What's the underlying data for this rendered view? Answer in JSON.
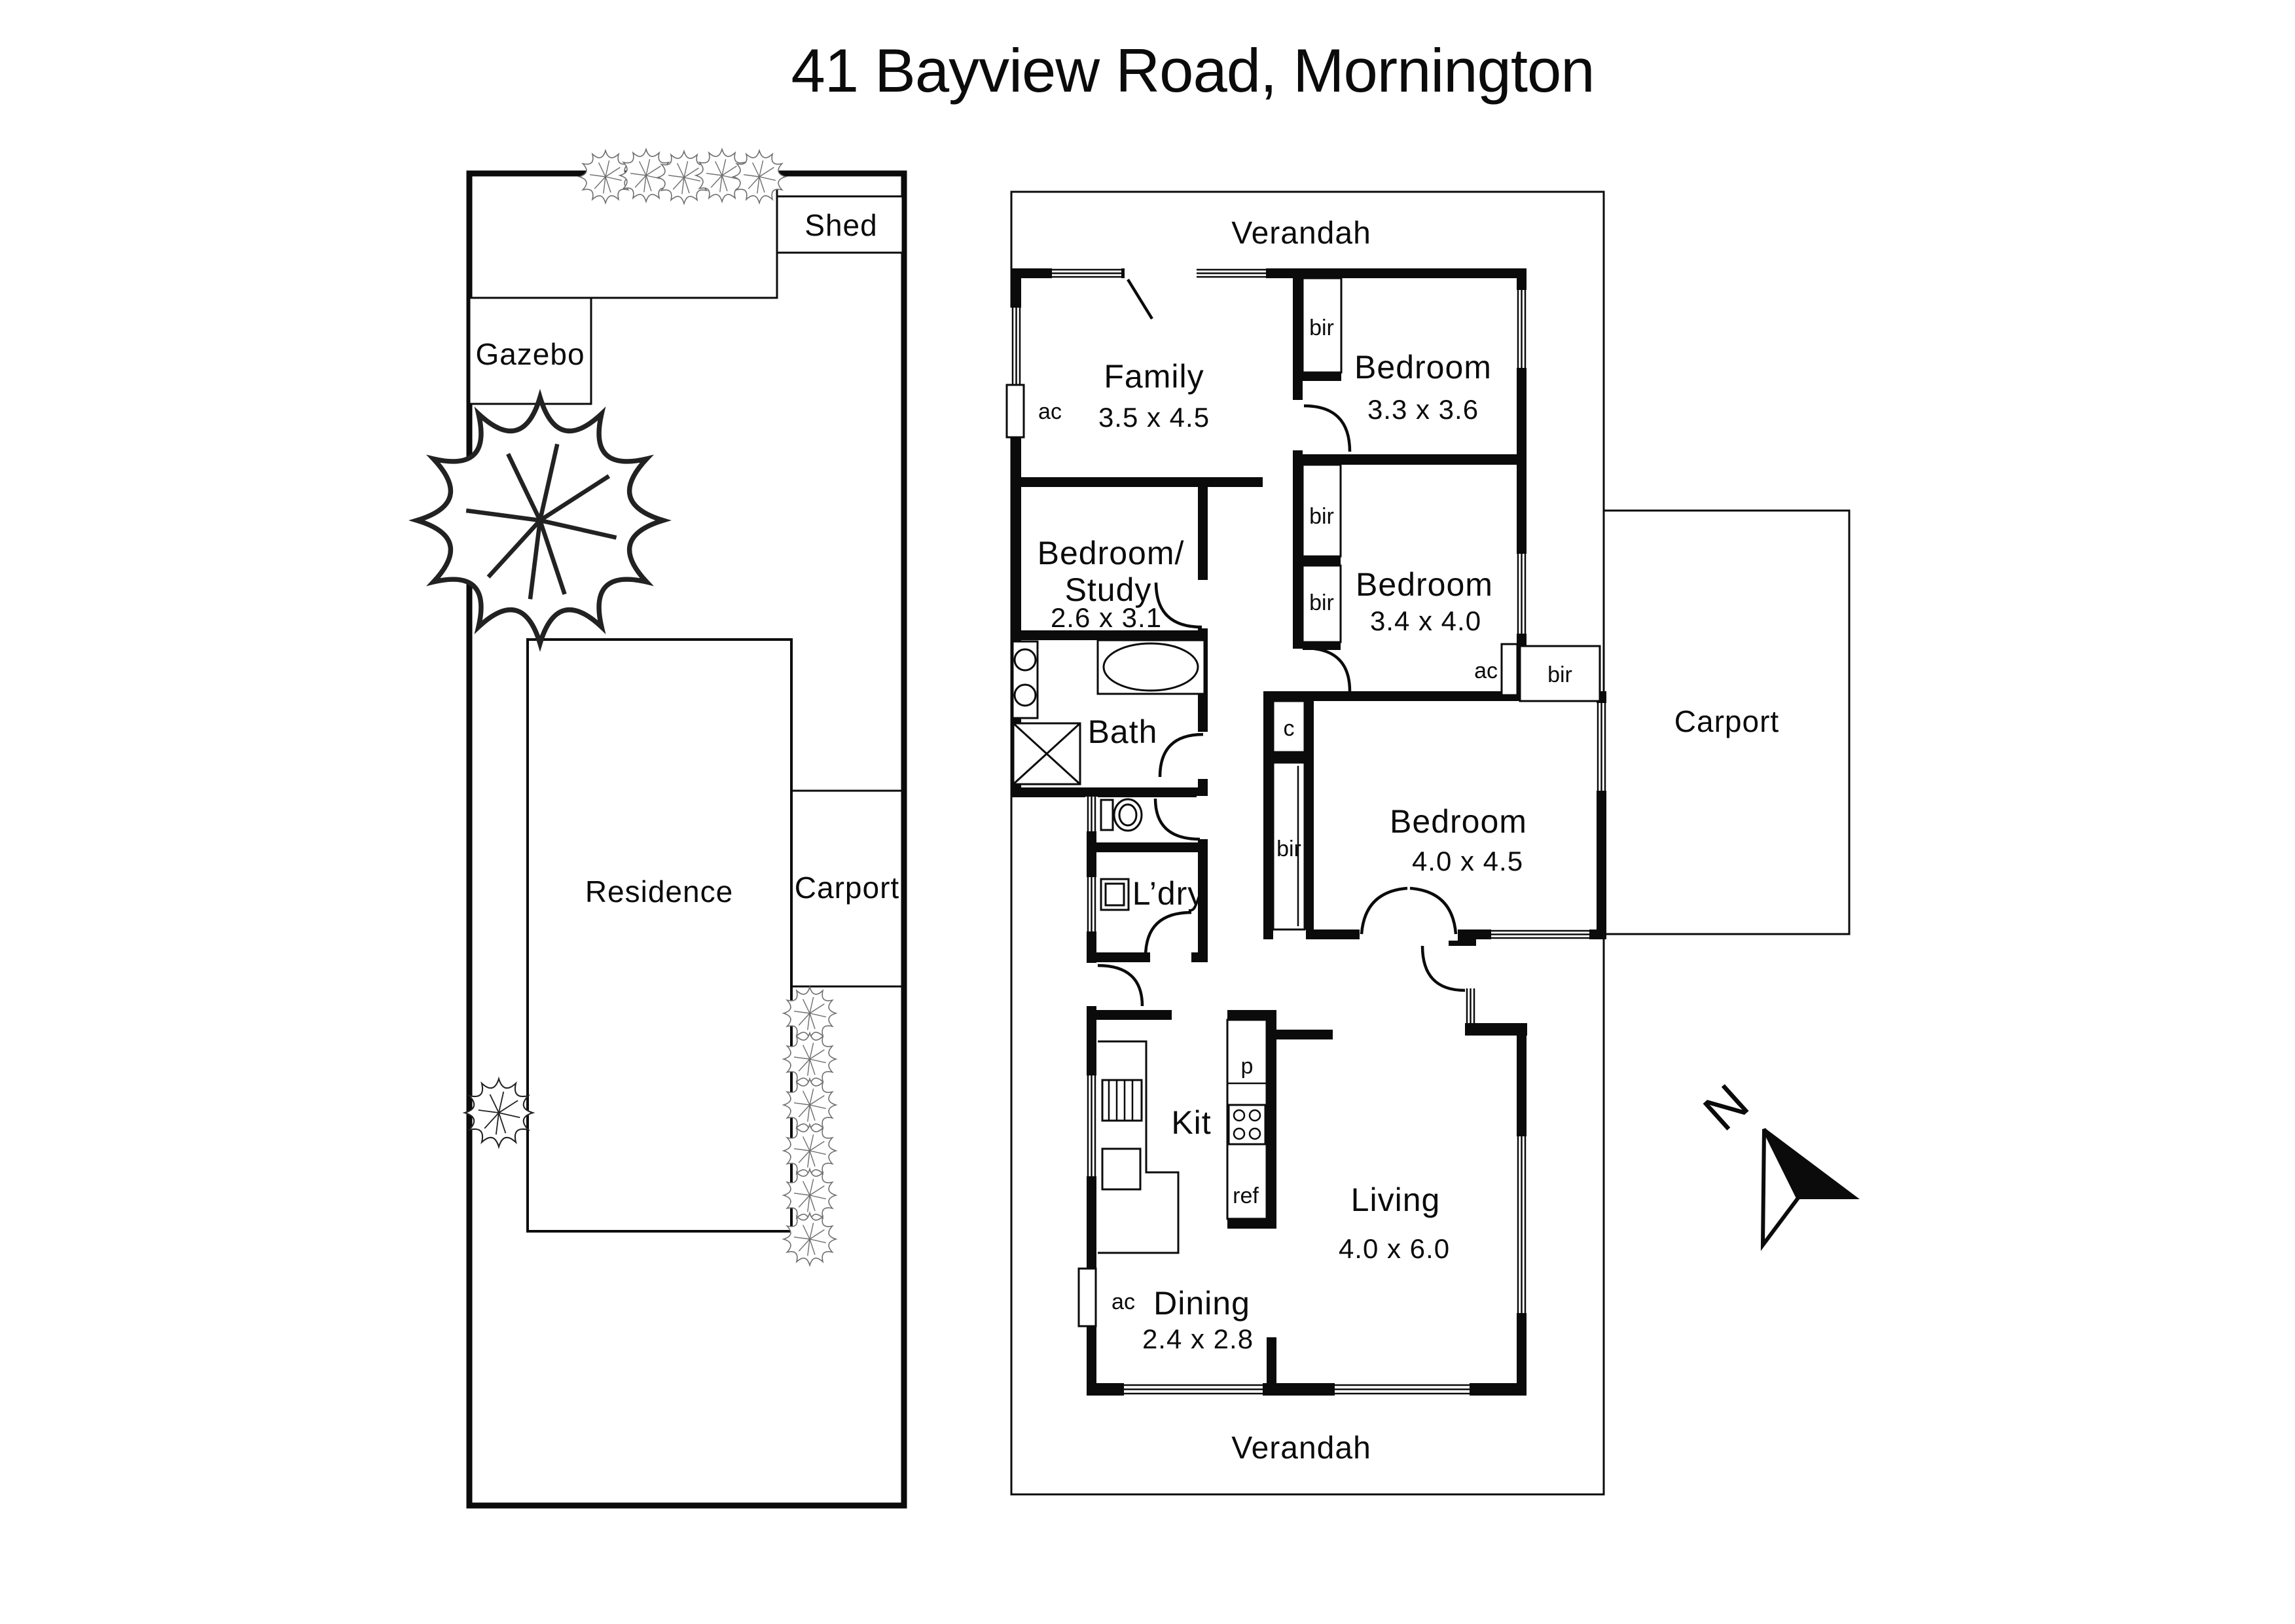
{
  "title": "41 Bayview Road, Mornington",
  "site_plan": {
    "shed_label": "Shed",
    "gazebo_label": "Gazebo",
    "residence_label": "Residence",
    "carport_label": "Carport"
  },
  "floor_plan": {
    "verandah_top": "Verandah",
    "verandah_bottom": "Verandah",
    "carport_label": "Carport",
    "rooms": {
      "family": {
        "label": "Family",
        "size": "3.5 x 4.5"
      },
      "bedroom_1": {
        "label": "Bedroom",
        "size": "3.3 x 3.6"
      },
      "bedroom_2": {
        "label": "Bedroom",
        "size": "3.4 x 4.0"
      },
      "bedroom_3": {
        "label": "Bedroom",
        "size": "4.0 x 4.5"
      },
      "bedroom_study": {
        "label_line1": "Bedroom/",
        "label_line2": "Study",
        "size": "2.6 x 3.1"
      },
      "bath": {
        "label": "Bath"
      },
      "laundry": {
        "label": "L’dry"
      },
      "kitchen": {
        "label": "Kit"
      },
      "living": {
        "label": "Living",
        "size": "4.0 x 6.0"
      },
      "dining": {
        "label": "Dining",
        "size": "2.4 x 2.8"
      }
    },
    "fixtures": {
      "built_in_robe": "bir",
      "air_conditioner": "ac",
      "cupboard": "c",
      "pantry": "p",
      "refrigerator": "ref"
    }
  },
  "compass": {
    "north": "N"
  }
}
